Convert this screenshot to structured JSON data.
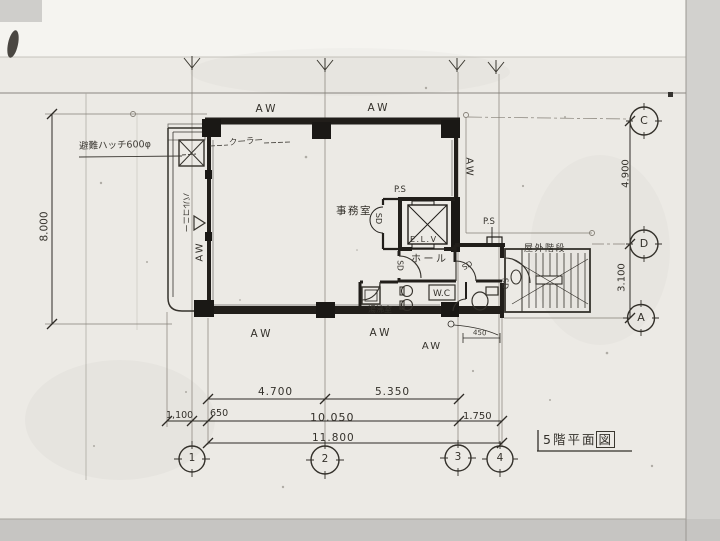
{
  "sheet": {
    "title_main": "5階平面",
    "title_boxed": "図"
  },
  "labels": {
    "aw": "AW",
    "sd": "SD",
    "ps": "P.S",
    "elv": "E.L.V"
  },
  "rooms": {
    "office": "事務室",
    "hall": "ホール",
    "wc": "W.C",
    "kitchenette": "湯沸室",
    "balcony": "バルコニー",
    "outdoor_stairs": "屋外階段"
  },
  "annotations": {
    "escape_hatch": "避難ハッチ600φ",
    "cooler": "クーラー"
  },
  "dimensions": {
    "left_total": "8.000",
    "right_upper": "4.900",
    "right_lower": "3.100",
    "bottom_row1": [
      "4.700",
      "5.350"
    ],
    "bottom_row2": [
      "1,100",
      "650",
      "10.050",
      "1.750"
    ],
    "bottom_total": "11.800",
    "small": "450"
  },
  "grid": {
    "columns": [
      "1",
      "2",
      "3",
      "4"
    ],
    "rows": [
      "C",
      "D",
      "A"
    ]
  }
}
